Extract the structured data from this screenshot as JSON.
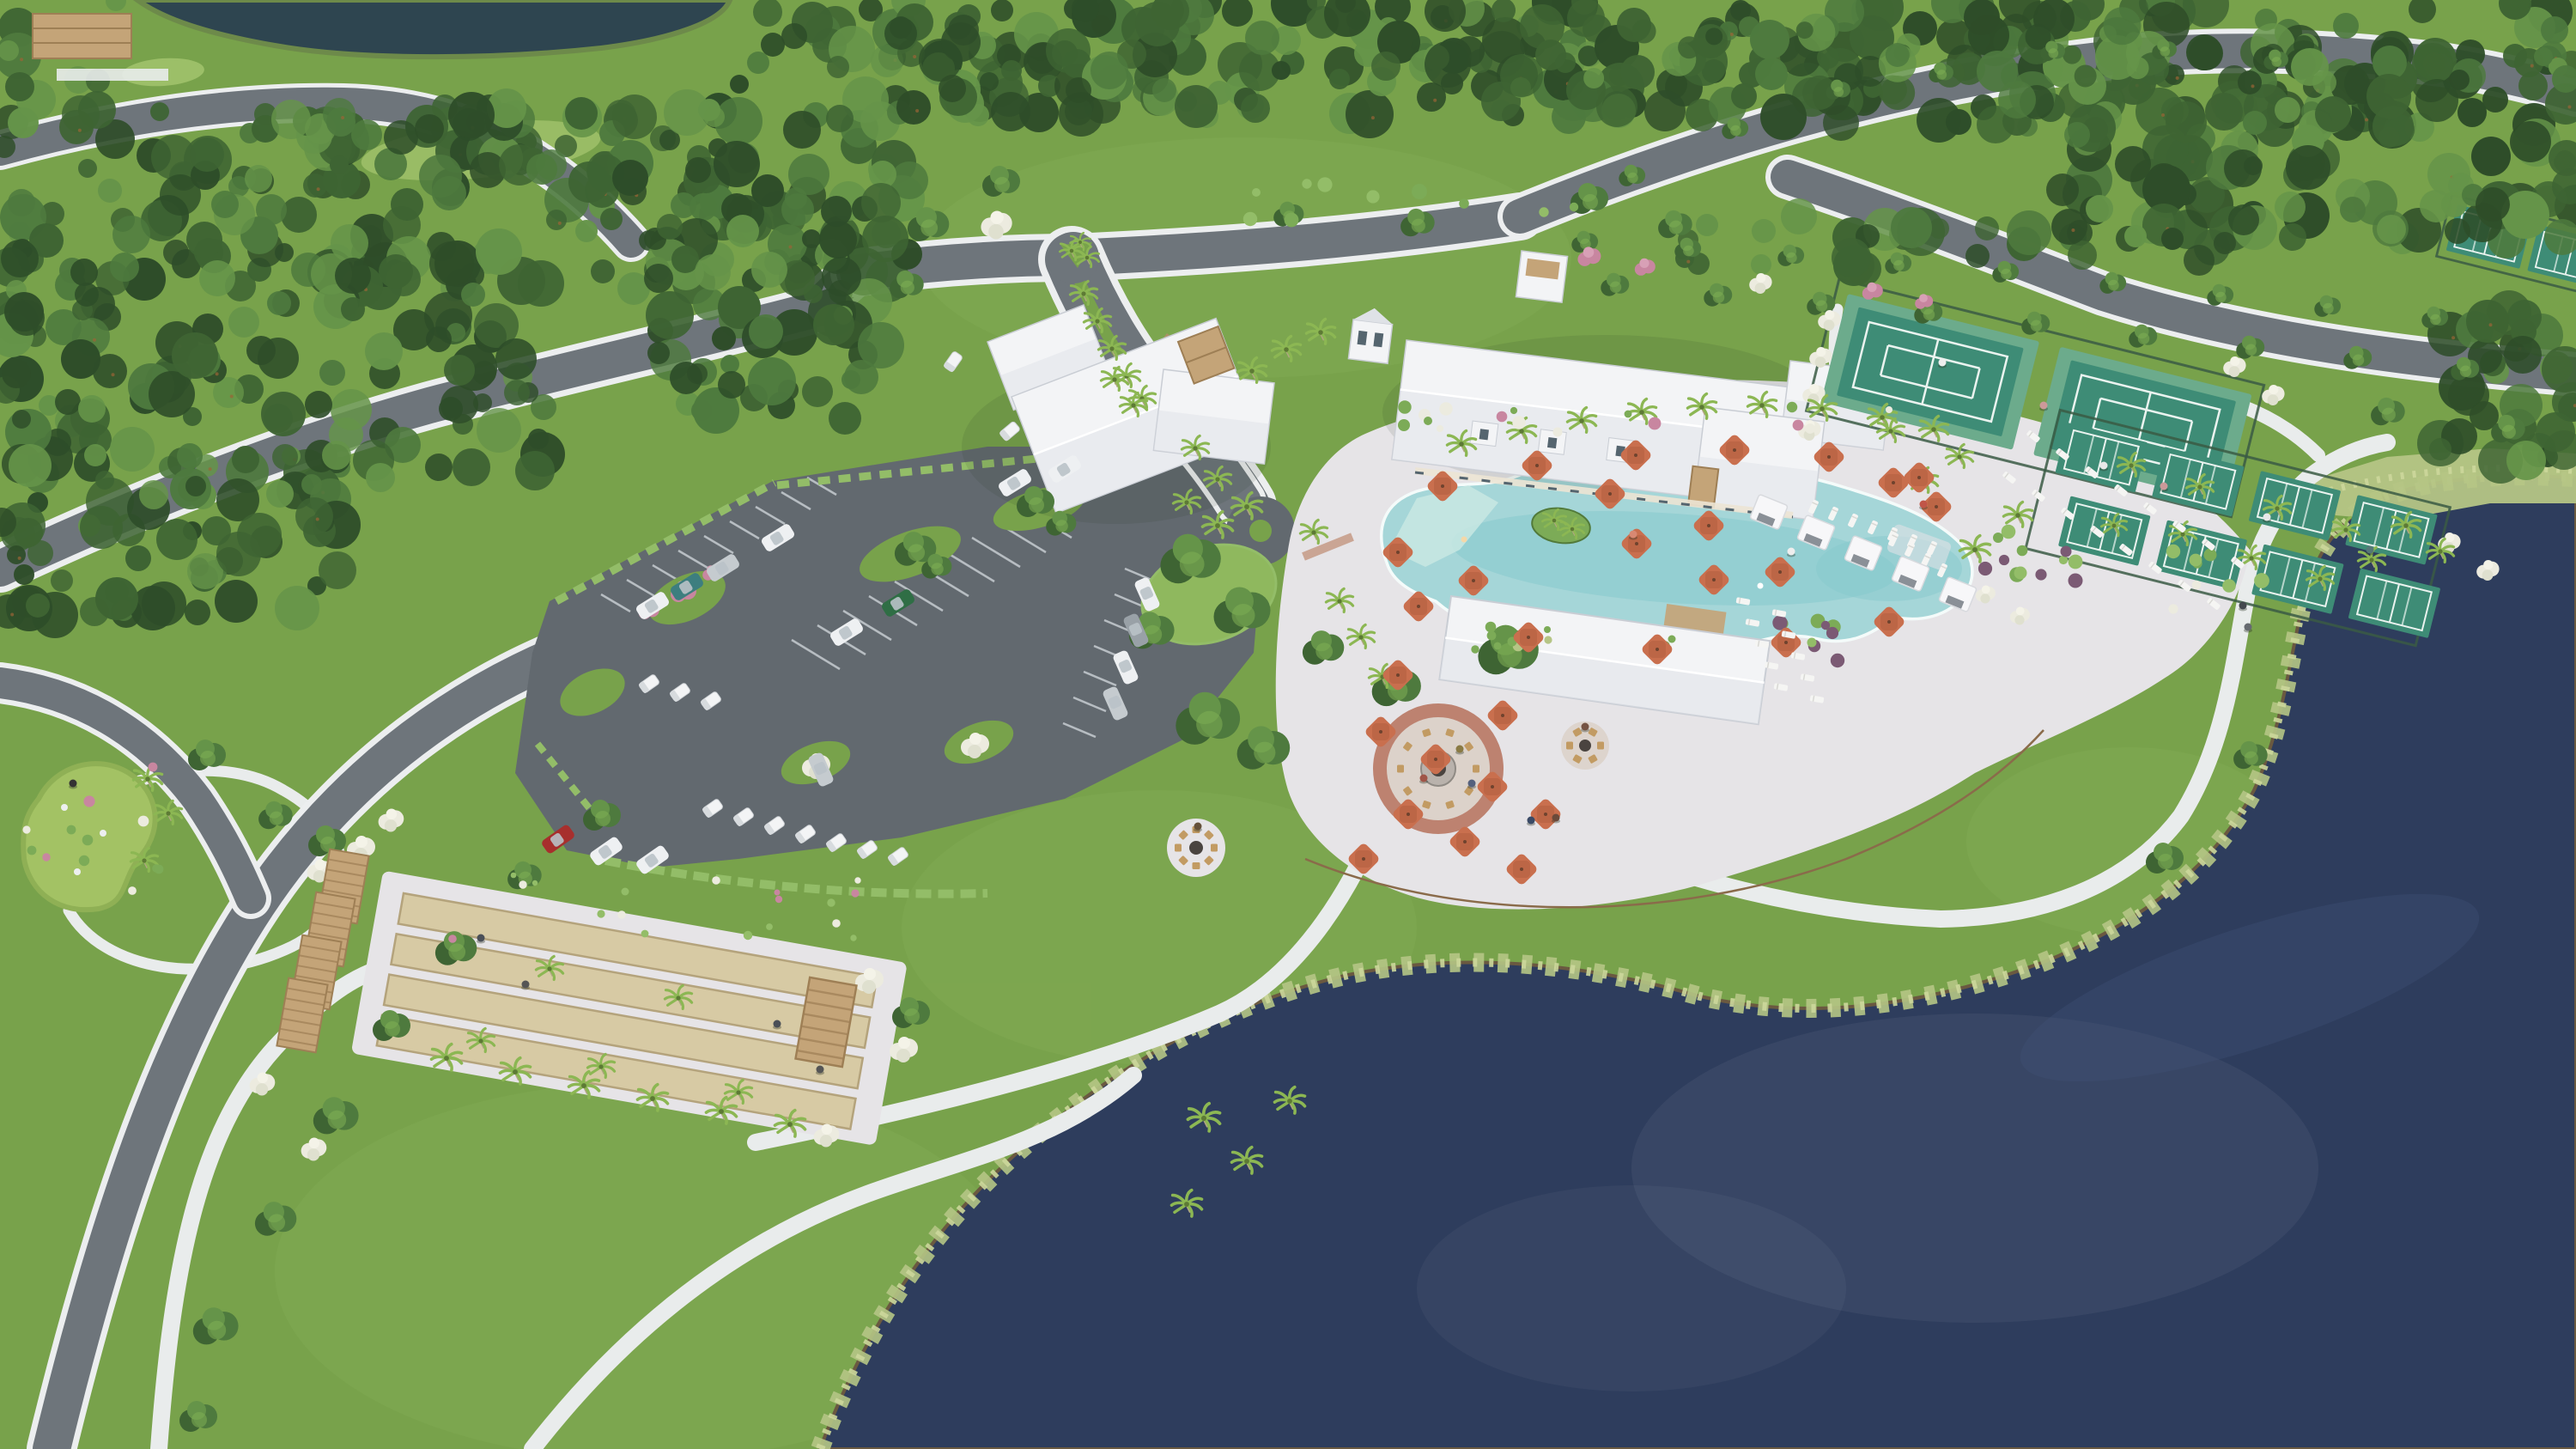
{
  "meta": {
    "type": "aerial-architectural-rendering",
    "view": "oblique-aerial",
    "subject": "Master-planned community amenity campus with clubhouse, lagoon resort pool, sports courts, bocce, parking and lake"
  },
  "scene": {
    "setting": "Amenity center clearing surrounded by dense pine forest, bordered by a large dark lake at lower right",
    "water": [
      "lake",
      "forest-pond",
      "marsh-edge"
    ],
    "amenities": [
      "pine-forest",
      "residential-homes",
      "entry-boulevard",
      "clubhouse",
      "resort-pool",
      "pool-beach-entry",
      "pool-island",
      "pool-bar",
      "dining-terrace",
      "cabanas",
      "fire-pit-plaza",
      "event-lawn",
      "tennis-courts",
      "pickleball-courts",
      "bocce-courts",
      "pergolas",
      "putting-green",
      "parking-lot",
      "golf-cart-parking",
      "walking-paths",
      "pavilion",
      "lake",
      "marsh-edge"
    ],
    "counts": {
      "tennis_courts": 2,
      "pickleball_courts": 8,
      "additional_courts": 2,
      "bocce_lanes": 4,
      "bocce_pergolas": 5,
      "pool_cabanas": 5,
      "pool_umbrellas": 30,
      "lounge_chairs": 37,
      "fire_pit_lounges": 3,
      "parked_cars": 16,
      "golf_carts": 12,
      "homes": 18
    }
  },
  "palette": {
    "lawn": "#78a24b",
    "lawnLight": "#8fb85e",
    "lawnDark": "#5e8a3b",
    "can1": "#2e4d29",
    "can2": "#3e6433",
    "can3": "#4e7a3e",
    "can4": "#659449",
    "canHi": "#7fae54",
    "trunk": "#9a6436",
    "road": "#6e757b",
    "sidewalk": "#eceeef",
    "path": "#e9ecec",
    "parking": "#62696f",
    "stall": "#cdd3d7",
    "lake": "#2e3d5d",
    "lakeDeep": "#273449",
    "lakeLight": "#45567c",
    "marsh": "#b5c585",
    "marshLight": "#ccd79b",
    "shoreMud": "#6a5940",
    "pool": "#a5d6d8",
    "poolDeep": "#84c7cb",
    "poolBeach": "#c8e7e3",
    "deck": "#e6e4e7",
    "deckShadow": "#d5d3d7",
    "roofWhite": "#f3f4f6",
    "roofShade": "#dfe2e7",
    "roofLine": "#c9cdd4",
    "wallCream": "#ece4d4",
    "windowDark": "#55656f",
    "umb": "#c96f4e",
    "umbDark": "#ae5a3d",
    "lounger": "#f5f5f3",
    "chairTan": "#c29b63",
    "courtApron": "#6cab8c",
    "courtSurf": "#3e8c76",
    "courtLine": "#eaf3ef",
    "fence": "#3a5a44",
    "bocceSand": "#d7caa4",
    "bocceEdge": "#b4a37c",
    "pergola": "#c4a478",
    "pergolaDark": "#9e7f55",
    "houseRoof": "#cec5b2",
    "houseRoofDark": "#a89c85",
    "houseWall": "#f0e4c9",
    "paverRing": "#bd8270",
    "paverIn": "#dcd2ca",
    "firepit": "#4a4440",
    "crape": "#c886a0",
    "bloom": "#ecebdf",
    "shrub": "#7cab57",
    "shrubDark": "#527a3a",
    "purple": "#7b5a74",
    "hedge": "#93bd68",
    "palmG": "#8cb753",
    "palmT": "#b3a486",
    "carWhite": "#eef0f2",
    "carGray": "#99a1a7",
    "carRed": "#a72f2d",
    "carTeal": "#3d7e7f",
    "carGreen": "#2f6e45",
    "carSilver": "#c5cbcf",
    "person": "#4a4f57"
  }
}
